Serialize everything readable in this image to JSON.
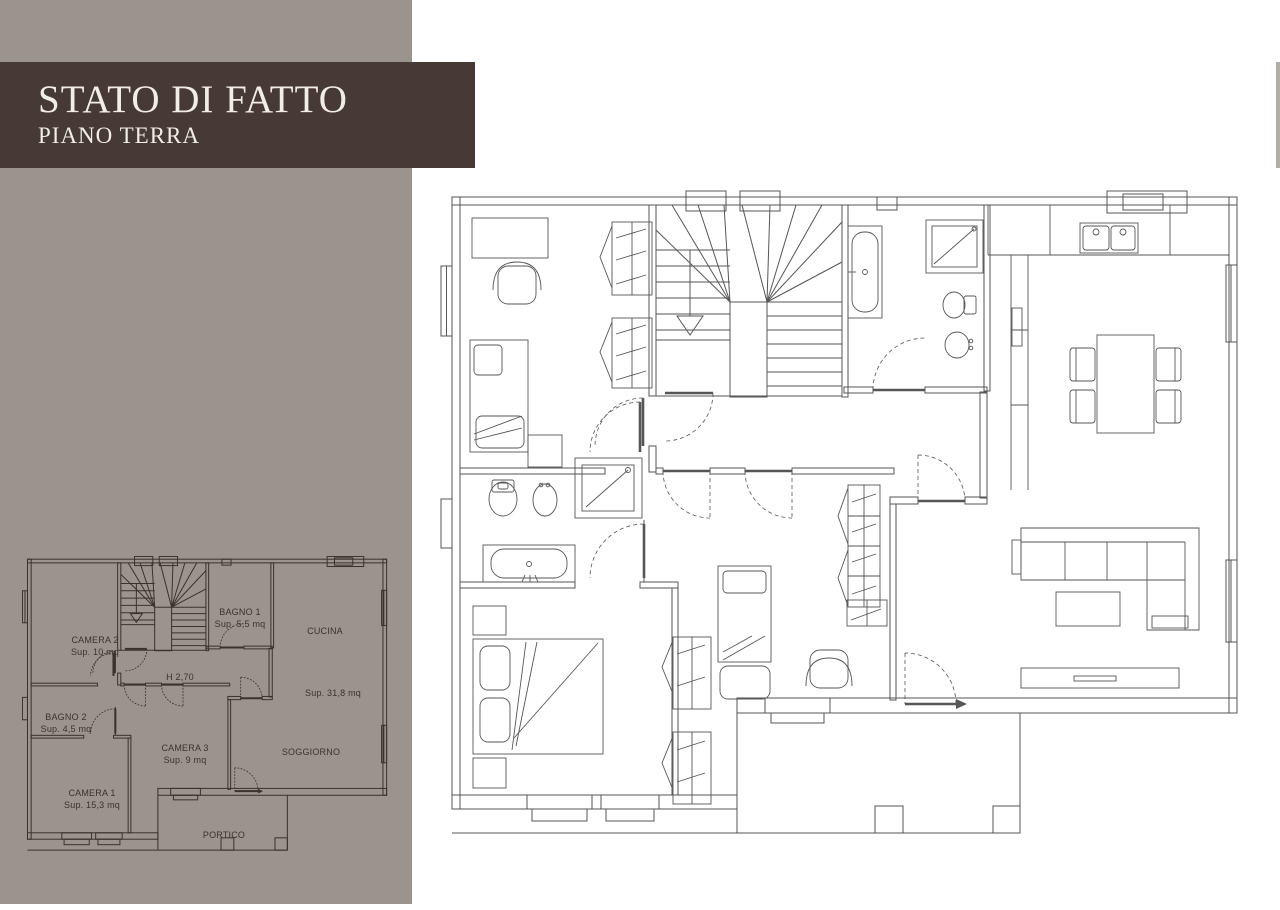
{
  "title_block": {
    "title": "STATO DI FATTO",
    "subtitle": "PIANO TERRA"
  },
  "small_plan": {
    "ceiling_height_label": "H 2,70",
    "rooms": [
      {
        "name": "CAMERA 2",
        "area": "Sup. 10 mq"
      },
      {
        "name": "BAGNO 1",
        "area": "Sup. 5,5 mq"
      },
      {
        "name": "CUCINA",
        "area": "Sup. 31,8 mq"
      },
      {
        "name": "BAGNO 2",
        "area": "Sup. 4,5 mq"
      },
      {
        "name": "CAMERA 3",
        "area": "Sup. 9 mq"
      },
      {
        "name": "SOGGIORNO",
        "area": ""
      },
      {
        "name": "CAMERA 1",
        "area": "Sup. 15,3 mq"
      },
      {
        "name": "PORTICO",
        "area": ""
      }
    ]
  },
  "colors": {
    "background": "#ffffff",
    "sidebar_gray": "#9a948c",
    "banner_brown": "#473a35",
    "banner_text": "#f2eee7",
    "large_plan_lines": "#565656",
    "small_plan_lines": "#39332d"
  }
}
